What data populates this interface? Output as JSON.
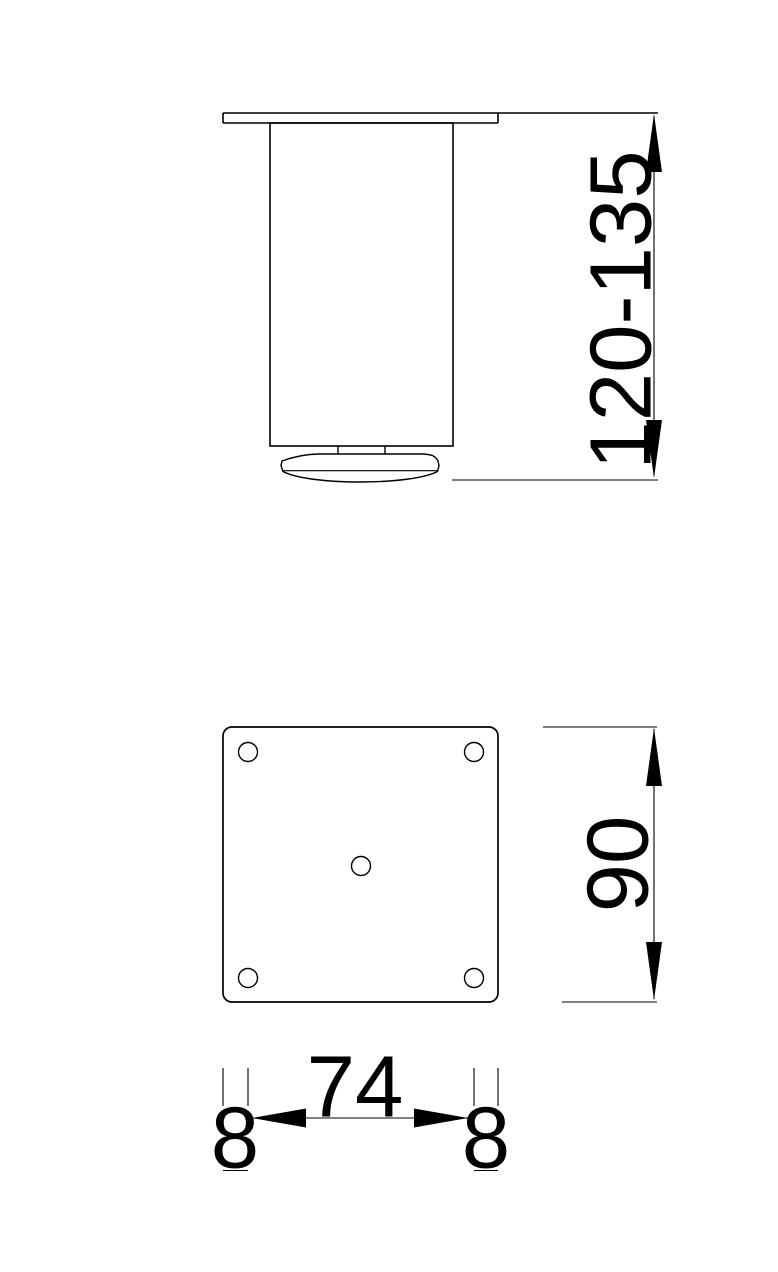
{
  "colors": {
    "background": "#ffffff",
    "line": "#000000",
    "text": "#000000"
  },
  "dimensions": {
    "leg_height_range": "120-135",
    "plate_size": "90",
    "hole_spacing": "74",
    "edge_offset_left": "8",
    "edge_offset_right": "8"
  }
}
